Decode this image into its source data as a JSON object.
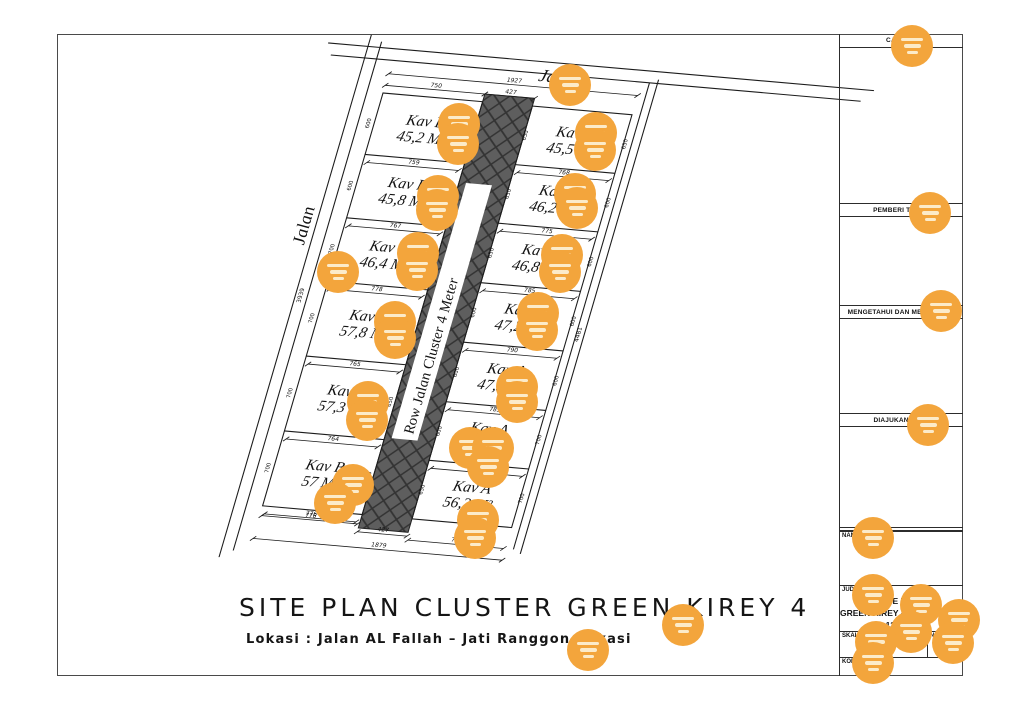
{
  "plan_footer": {
    "title": "SITE PLAN CLUSTER GREEN KIREY 4",
    "location": "Lokasi : Jalan AL Fallah – Jati Ranggon Bekasi"
  },
  "site_plan": {
    "street_top_label": "Jalan",
    "street_left_label": "Jalan",
    "center_road_label": "Row Jalan Cluster 4 Meter",
    "blocks": {
      "left": {
        "name": "Kav B",
        "areas": [
          "45,2 M²",
          "45,8 M²",
          "46,4 M²",
          "57,8 M²",
          "57,3 M²",
          "57 M²"
        ],
        "bottom_dims": [
          "759",
          "767",
          "778",
          "765",
          "764",
          "776"
        ],
        "edge_dims": [
          "600",
          "600",
          "700",
          "700",
          "700",
          "700"
        ],
        "road_edge_dims": [
          "600",
          "600",
          "650",
          "650",
          "650",
          "650"
        ]
      },
      "right": {
        "name": "Kav A",
        "areas": [
          "45,5 M²",
          "46,2 M²",
          "46,8 M²",
          "47,2 M²",
          "47,5 M²",
          "51 M²",
          "56,2 M²"
        ],
        "bottom_dims": [
          "768",
          "775",
          "785",
          "790",
          "785",
          "779"
        ],
        "edge_dims": [
          "650",
          "600",
          "600",
          "600",
          "600",
          "700",
          "700"
        ],
        "road_edge_dims": [
          "650",
          "650",
          "650",
          "600",
          "600",
          "600",
          "650"
        ]
      }
    },
    "dims": {
      "top_overall": "1927",
      "top_left": "750",
      "top_road": "427",
      "bottom_left": "776",
      "bottom_road": "427",
      "bottom_right": "776",
      "bottom_overall": "1879",
      "left_boundary": "3939",
      "right_boundary": "4481"
    }
  },
  "title_block": {
    "catatan_label": "CATATAN",
    "pemberi_label": "PEMBERI TUGAS",
    "mengetahui_label": "MENGETAHUI DAN MENYETUJUI",
    "diajukan_label": "DIAJUKAN OLEH",
    "nama_label": "NAMA KEGIATAN",
    "judul_label": "JUDUL GAMBAR",
    "judul_lines": [
      "SITE PLAN",
      "GREEN KIREY 4 JATI RANGGON",
      "13 UNIT"
    ],
    "skala_label": "SKALA GAMBAR",
    "skala_value": "1 : 100",
    "no_label": "NO. URUT",
    "kode_label": "KODE GAMBAR"
  },
  "colors": {
    "line": "#1c1c1c",
    "road_fill": "#5e5e5e",
    "road_hatch": "#333333",
    "marker": "#F3A53C",
    "marker_bar": "#FCEBC9"
  },
  "markers": [
    [
      570,
      85
    ],
    [
      459,
      124
    ],
    [
      458,
      144
    ],
    [
      596,
      133
    ],
    [
      595,
      150
    ],
    [
      438,
      196
    ],
    [
      437,
      210
    ],
    [
      575,
      194
    ],
    [
      577,
      208
    ],
    [
      338,
      272
    ],
    [
      418,
      253
    ],
    [
      417,
      270
    ],
    [
      562,
      255
    ],
    [
      560,
      272
    ],
    [
      395,
      322
    ],
    [
      395,
      338
    ],
    [
      538,
      313
    ],
    [
      537,
      330
    ],
    [
      368,
      402
    ],
    [
      367,
      420
    ],
    [
      517,
      387
    ],
    [
      517,
      402
    ],
    [
      470,
      448
    ],
    [
      493,
      448
    ],
    [
      488,
      467
    ],
    [
      353,
      485
    ],
    [
      335,
      503
    ],
    [
      478,
      520
    ],
    [
      475,
      538
    ],
    [
      683,
      625
    ],
    [
      588,
      650
    ],
    [
      912,
      46
    ],
    [
      930,
      213
    ],
    [
      941,
      311
    ],
    [
      928,
      425
    ],
    [
      873,
      538
    ],
    [
      873,
      595
    ],
    [
      921,
      605
    ],
    [
      959,
      620
    ],
    [
      911,
      632
    ],
    [
      876,
      642
    ],
    [
      953,
      643
    ],
    [
      873,
      663
    ]
  ]
}
